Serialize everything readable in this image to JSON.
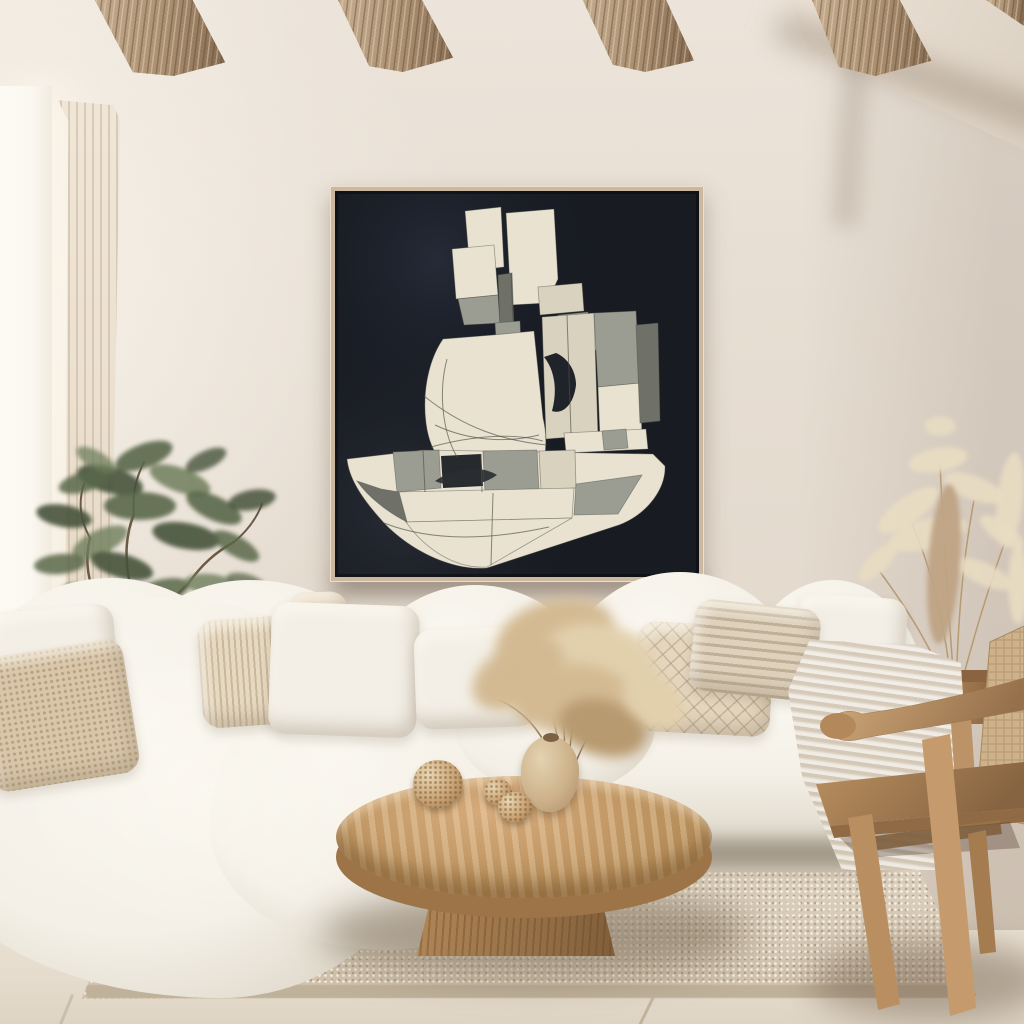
{
  "scene_type": "interior photograph, boho-minimalist living room, no visible text",
  "visible_objects": [
    "rustic wood ceiling beams",
    "cream plaster walls with diagonal soffit",
    "window with sheer linen curtain",
    "large abstract geometric painting (cream and gray cubist forms on near-black ground) in thin light-wood frame",
    "white cloud modular sofa",
    "boucle, fringe, diamond-quilt and plain throw pillows",
    "cream throw blanket on sofa arm",
    "olive tree houseplant",
    "round organic wood-slab coffee table on pedestal base",
    "ceramic vase with tall dried pampas arrangement",
    "three woven knot decor balls",
    "teak armchair with woven rattan back",
    "pampas grass in round wooden planter",
    "textured beige area rug",
    "light oak floor"
  ],
  "palette": {
    "wall": "#e7ded3",
    "wall_light": "#f6f1e8",
    "wall_shadow": "#d9ccbd",
    "soffit_light": "#f0e8dc",
    "soffit_dark": "#dbd0c2",
    "beam_light": "#c6ad8f",
    "beam_mid": "#a98e70",
    "beam_dark": "#82684e",
    "window_glow": "#fbf8f1",
    "curtain": "#ece1d0",
    "curtain_fold": "#b9a58a",
    "frame_wood": "#cbb89f",
    "painting_bg": "#181b22",
    "art_cream": "#e9e2d1",
    "art_cream2": "#d9d2bf",
    "art_gray": "#9c9d92",
    "art_gray_dark": "#6f7168",
    "art_line": "#4e4f47",
    "sofa": "#f4f0e7",
    "sofa_hi": "#faf7f0",
    "sofa_sh": "#d9d2c3",
    "pillow_white": "#f3efe6",
    "pillow_beige": "#e4d6bf",
    "pillow_boucle": "#d9c6a9",
    "pillow_fringe": "#e6d9c1",
    "throw": "#ddd3c3",
    "plant_dark": "#46523b",
    "plant_mid": "#596749",
    "plant_light": "#6e7d5b",
    "trunk": "#6b5943",
    "pampas": "#e8dcc2",
    "pampas_tan": "#bfa384",
    "pampas_stem": "#b69a72",
    "pot_wood": "#a87f55",
    "table_top": "#cda672",
    "table_mid": "#b8905c",
    "table_dark": "#8f6a42",
    "knot": "#caa375",
    "vase_light": "#e4d2b0",
    "vase_dark": "#b2946c",
    "dried": "#d3ba93",
    "chair_light": "#d2aa7c",
    "chair_mid": "#b98f60",
    "chair_dark": "#95704a",
    "weave": "#cdb28b",
    "weave_line": "#ab8d64",
    "rug": "#d7cab6",
    "rug_edge": "#c0b19b",
    "floor": "#e5dccd",
    "floor_line": "#9f8a6d",
    "shadow": "#6b5a45"
  }
}
